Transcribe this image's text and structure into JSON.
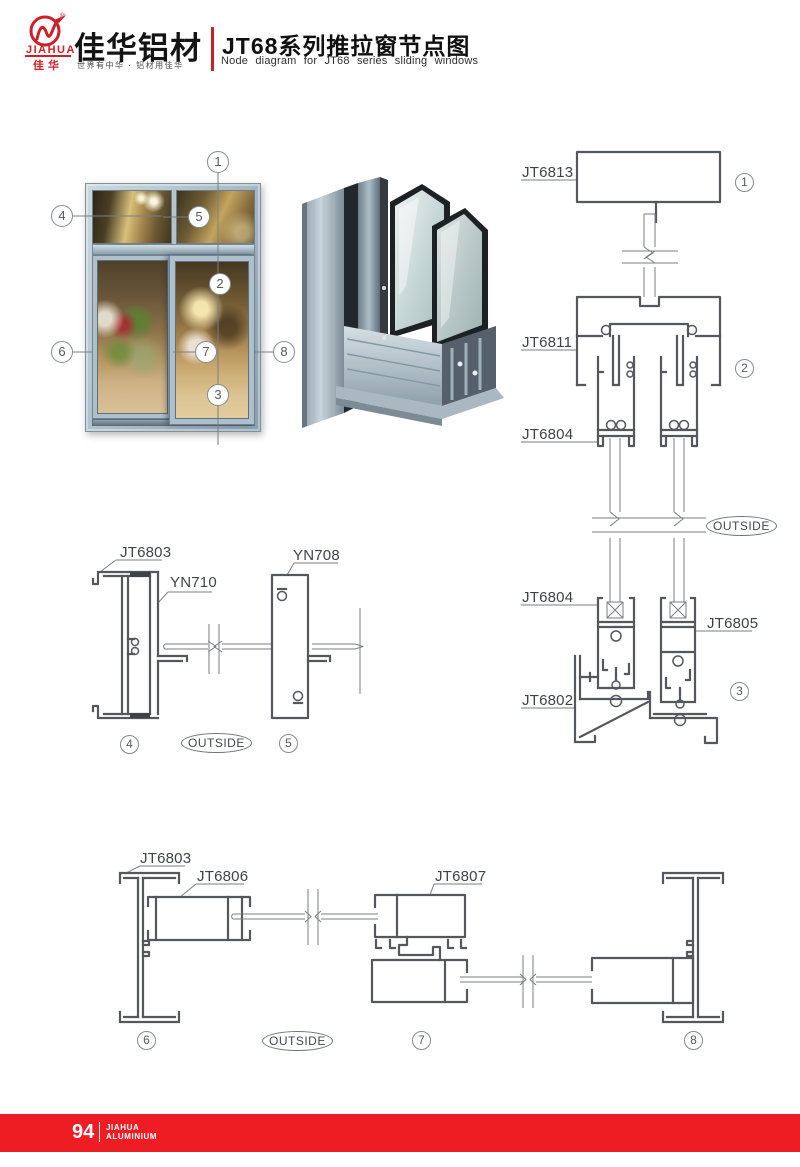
{
  "header": {
    "logo": {
      "brand_en": "JIAHUA",
      "brand_cn": "佳华",
      "registered": "®"
    },
    "company_name": "佳华铝材",
    "slogan": "世界有中华 · 铝材用佳华",
    "title_cn": "JT68系列推拉窗节点图",
    "title_en": "Node diagram for JT68 series sliding windows"
  },
  "figure": {
    "callouts": {
      "c1": "1",
      "c2": "2",
      "c3": "3",
      "c4": "4",
      "c5": "5",
      "c6": "6",
      "c7": "7",
      "c8": "8"
    }
  },
  "labels": {
    "jt6813": "JT6813",
    "jt6811": "JT6811",
    "jt6804": "JT6804",
    "jt6805": "JT6805",
    "jt6802": "JT6802",
    "jt6803": "JT6803",
    "yn710": "YN710",
    "yn708": "YN708",
    "jt6806": "JT6806",
    "jt6807": "JT6807",
    "outside": "OUTSIDE"
  },
  "colors": {
    "brand_red": "#cf2027",
    "footer_red": "#ee1c23",
    "diagram_line": "#54585c",
    "window_frame": "#a7bac5"
  },
  "footer": {
    "page_number": "94",
    "brand_line1": "JIAHUA",
    "brand_line2": "ALUMINIUM"
  }
}
